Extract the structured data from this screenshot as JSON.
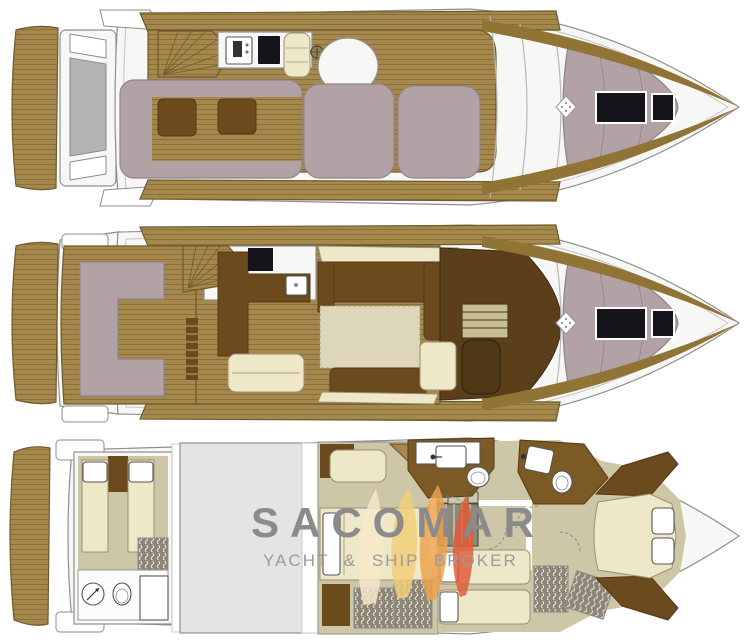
{
  "watermark": {
    "title": "SACOMAR",
    "subtitle": "YACHT & SHIP BROKER"
  },
  "icons": {
    "flame-logo": "four overlapping flame-sail shapes",
    "windlass": "white diamond with dots",
    "shower": "circle with diagonal arrow",
    "toilet": "oval bowl",
    "washbasin": "square with faucet dot",
    "helm-wheel": "spoked circle",
    "grill": "square with dark burner",
    "fridge": "dark rectangle",
    "wardrobe": "gray box with wavy hatching",
    "deck-hatch": "black rectangle"
  },
  "colors": {
    "bg": "#ffffff",
    "hull-white": "#f7f7f5",
    "hull-line": "#8f8f8f",
    "teak": "#a5894c",
    "teak-line": "#8a7038",
    "teak-dark": "#8f7435",
    "teak-edge": "#6e5a2c",
    "mauve": "#b2a2a5",
    "mauve-line": "#93838a",
    "brown": "#6b4a1e",
    "brown-dark": "#533914",
    "helm-floor": "#5a3f1a",
    "bath-floor": "#7b5a26",
    "cream": "#efe8c8",
    "cream-line": "#9a9071",
    "beige-floor": "#cdc6a7",
    "rug": "#ddd6b8",
    "engine-gray": "#e4e4e2",
    "wardrobe-gray": "#8d8578",
    "black": "#14141a",
    "watermark-gray": "#8b8b8b",
    "watermark-sub-gray": "#9b9b9b",
    "flame-cream": "#f7e9c9",
    "flame-yellow": "#f2cf79",
    "flame-orange": "#eda24d",
    "flame-red": "#df5b38"
  }
}
